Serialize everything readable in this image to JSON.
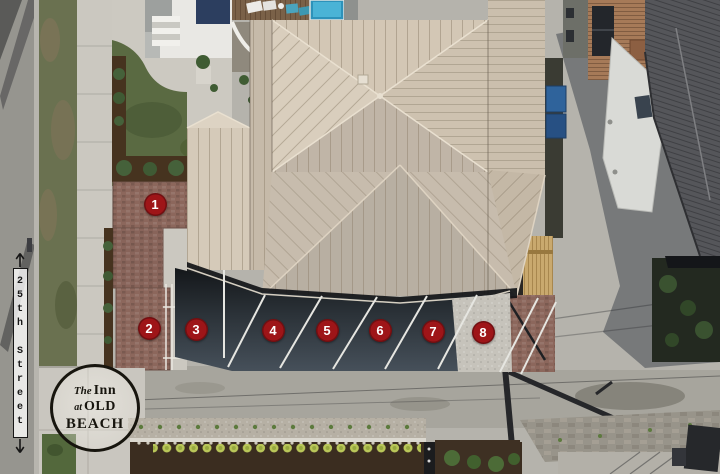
{
  "scene": {
    "description": "Aerial drone view of The Inn at Old Beach property showing eight numbered parking spaces, 25th Street on the left, neighboring houses and rear alley landscaping"
  },
  "street_label": {
    "text": "25th Street"
  },
  "parking_markers": [
    {
      "number": "1",
      "x": 155,
      "y": 204
    },
    {
      "number": "2",
      "x": 149,
      "y": 328
    },
    {
      "number": "3",
      "x": 196,
      "y": 329
    },
    {
      "number": "4",
      "x": 273,
      "y": 330
    },
    {
      "number": "5",
      "x": 327,
      "y": 330
    },
    {
      "number": "6",
      "x": 380,
      "y": 330
    },
    {
      "number": "7",
      "x": 433,
      "y": 331
    },
    {
      "number": "8",
      "x": 483,
      "y": 332
    }
  ],
  "logo": {
    "word_the": "The",
    "word_inn": "Inn",
    "word_at": "at",
    "word_old": "OLD",
    "word_beach": "BEACH"
  },
  "colors": {
    "marker_red": "#9e1518",
    "marker_text": "#ffffff",
    "label_ink": "#161616",
    "label_bg": "rgba(255,255,255,0.78)",
    "logo_ink": "#17150e"
  }
}
